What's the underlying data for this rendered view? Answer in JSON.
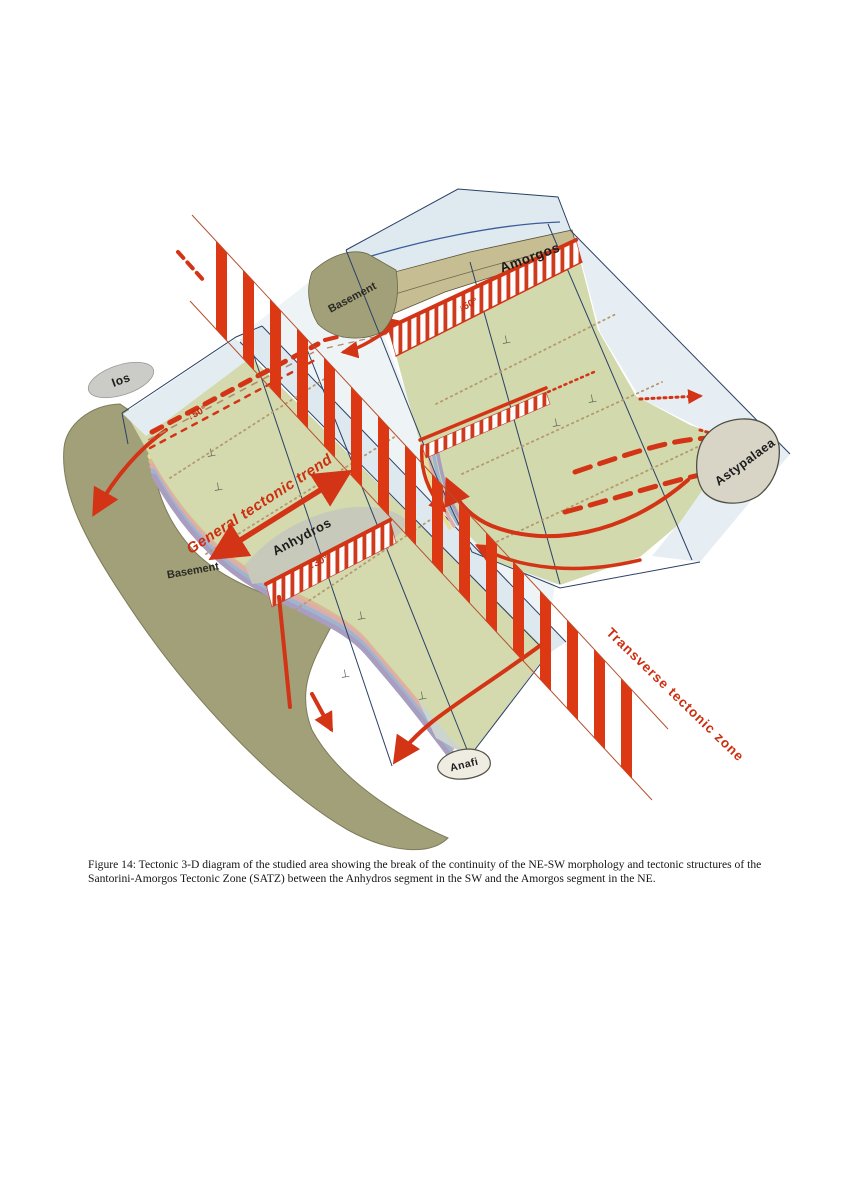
{
  "figure": {
    "caption": "Figure 14: Tectonic 3-D diagram of the studied area showing the break of the continuity of the NE-SW morphology and tectonic structures of the Santorini-Amorgos Tectonic Zone (SATZ) between the Anhydros segment in the SW and the Amorgos segment in the NE."
  },
  "diagram": {
    "islands": {
      "ios": "Ios",
      "amorgos": "Amorgos",
      "astypalaea": "Astypalaea",
      "anafi": "Anafi",
      "anhydros": "Anhydros"
    },
    "geology": {
      "basement_ne": "Basement",
      "basement_sw": "Basement"
    },
    "annotations": {
      "general_trend": "General tectonic trend",
      "transverse_zone": "Transverse tectonic zone",
      "dip_amorgos_fault": "↓60°",
      "dip_ios_fault": "↓50°",
      "dip_anhydros_fault": "↓30°"
    },
    "symbols": {
      "bedding": "⊥"
    },
    "colors": {
      "fault_red": "#d23415",
      "stripe_red": "#dd3814",
      "label_red": "#cc2f10",
      "box_blue": "#2b4066",
      "coast_blue": "#3d5c9c",
      "platform_green": "#d4daae",
      "basement_olive": "#a2a078",
      "sea_pale_blue": "#dfeaf0",
      "island_gray": "#d8d5c6",
      "dotted_tan": "#b59a6d"
    }
  }
}
